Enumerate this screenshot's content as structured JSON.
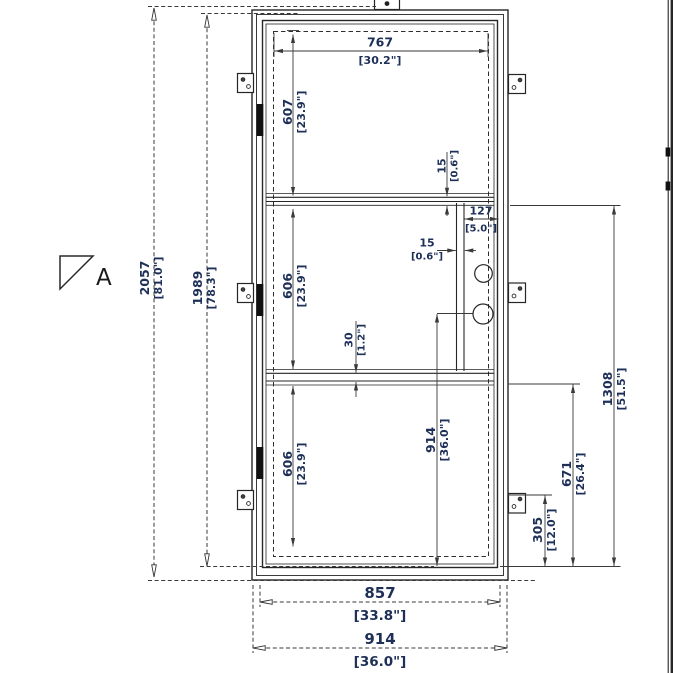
{
  "drawing": {
    "section_marker": {
      "label": "A"
    },
    "dimensions": {
      "overall_height": {
        "mm": "2057",
        "inches": "[81.0\"]"
      },
      "leaf_height": {
        "mm": "1989",
        "inches": "[78.3\"]"
      },
      "glass_width": {
        "mm": "767",
        "inches": "[30.2\"]"
      },
      "top_panel_height": {
        "mm": "607",
        "inches": "[23.9\"]"
      },
      "middle_panel_height": {
        "mm": "606",
        "inches": "[23.9\"]"
      },
      "bottom_panel_height": {
        "mm": "606",
        "inches": "[23.9\"]"
      },
      "top_rail_thickness": {
        "mm": "15",
        "inches": "[0.6\"]"
      },
      "lock_stile_offset": {
        "mm": "127",
        "inches": "[5.0\"]"
      },
      "lock_channel_width": {
        "mm": "15",
        "inches": "[0.6\"]"
      },
      "mid_rail_thickness": {
        "mm": "30",
        "inches": "[1.2\"]"
      },
      "handle_height": {
        "mm": "914",
        "inches": "[36.0\"]"
      },
      "lock_top_height": {
        "mm": "1308",
        "inches": "[51.5\"]"
      },
      "handle_zone_height": {
        "mm": "671",
        "inches": "[26.4\"]"
      },
      "bottom_plate_height": {
        "mm": "305",
        "inches": "[12.0\"]"
      },
      "leaf_width": {
        "mm": "857",
        "inches": "[33.8\"]"
      },
      "overall_width": {
        "mm": "914",
        "inches": "[36.0\"]"
      }
    }
  }
}
